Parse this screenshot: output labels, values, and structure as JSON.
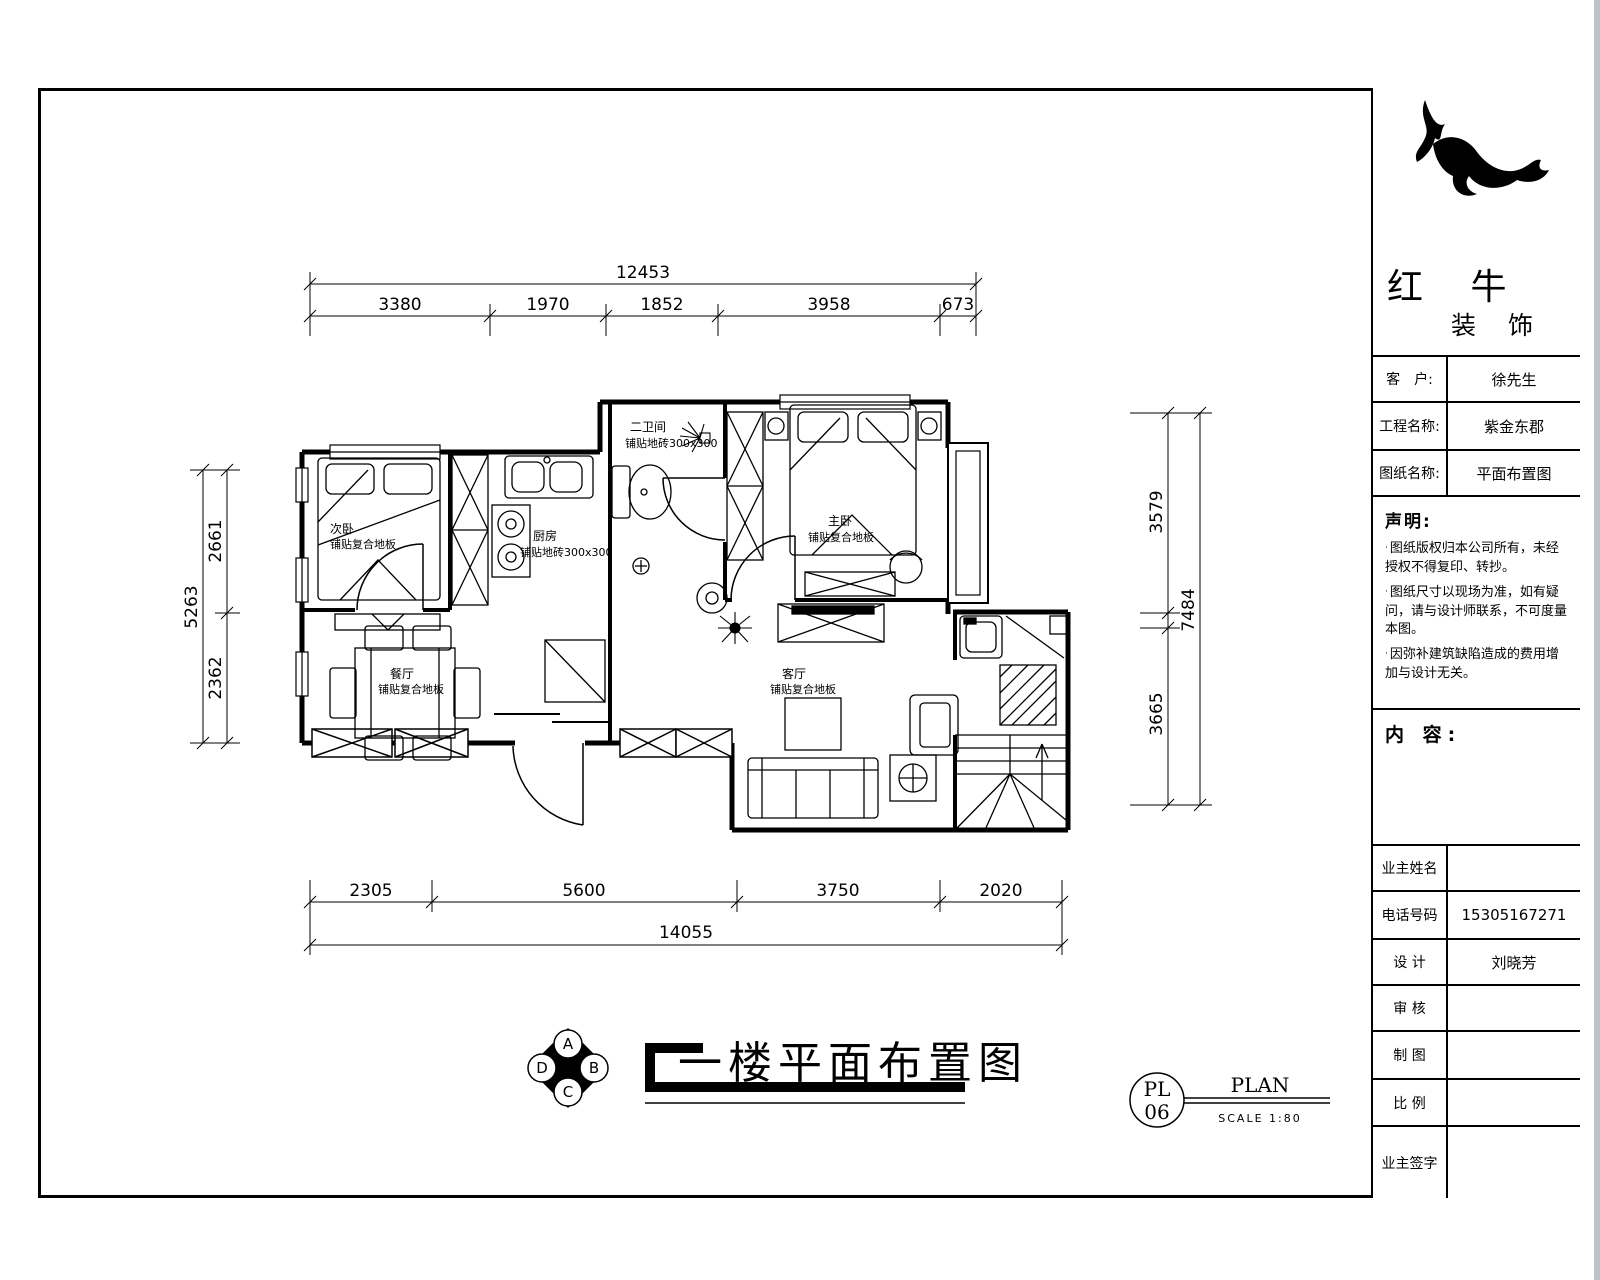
{
  "plan": {
    "drawing_title": "一楼平面布置图",
    "rooms": [
      {
        "name": "次卧",
        "finish": "铺贴复合地板"
      },
      {
        "name": "厨房",
        "finish": "铺贴地砖300x300"
      },
      {
        "name": "二卫间",
        "finish": "铺贴地砖300x300"
      },
      {
        "name": "主卧",
        "finish": "铺贴复合地板"
      },
      {
        "name": "餐厅",
        "finish": "铺贴复合地板"
      },
      {
        "name": "客厅",
        "finish": "铺贴复合地板"
      }
    ],
    "dimensions": {
      "top": {
        "total": "12453",
        "segments": [
          "3380",
          "1970",
          "1852",
          "3958",
          "673"
        ]
      },
      "bottom": {
        "total": "14055",
        "segments": [
          "2305",
          "5600",
          "3750",
          "2020"
        ]
      },
      "left": {
        "total": "5263",
        "segments": [
          "2661",
          "2362"
        ]
      },
      "right": {
        "total": "7484",
        "segments": [
          "3579",
          "3665"
        ]
      }
    },
    "compass": {
      "top": "A",
      "right": "B",
      "bottom": "C",
      "left": "D"
    },
    "stamp": {
      "code": "PL",
      "number": "06",
      "label": "PLAN",
      "scale": "SCALE 1:80"
    }
  },
  "titleblock": {
    "logo": {
      "name": "红 牛",
      "sub": "装 饰"
    },
    "fields": [
      {
        "label": "客　户:",
        "value": "徐先生"
      },
      {
        "label": "工程名称:",
        "value": "紫金东郡"
      },
      {
        "label": "图纸名称:",
        "value": "平面布置图"
      }
    ],
    "statement": {
      "heading": "声明:",
      "bullet": "·",
      "items": [
        "图纸版权归本公司所有，未经授权不得复印、转抄。",
        "图纸尺寸以现场为准，如有疑问，请与设计师联系，不可度量本图。",
        "因弥补建筑缺陷造成的费用增加与设计无关。"
      ]
    },
    "content_heading": "内 容:",
    "rows": [
      {
        "label": "业主姓名",
        "value": ""
      },
      {
        "label": "电话号码",
        "value": "15305167271"
      },
      {
        "label": "设 计",
        "value": "刘晓芳"
      },
      {
        "label": "审 核",
        "value": ""
      },
      {
        "label": "制 图",
        "value": ""
      },
      {
        "label": "比 例",
        "value": ""
      },
      {
        "label": "业主签字",
        "value": ""
      }
    ]
  }
}
